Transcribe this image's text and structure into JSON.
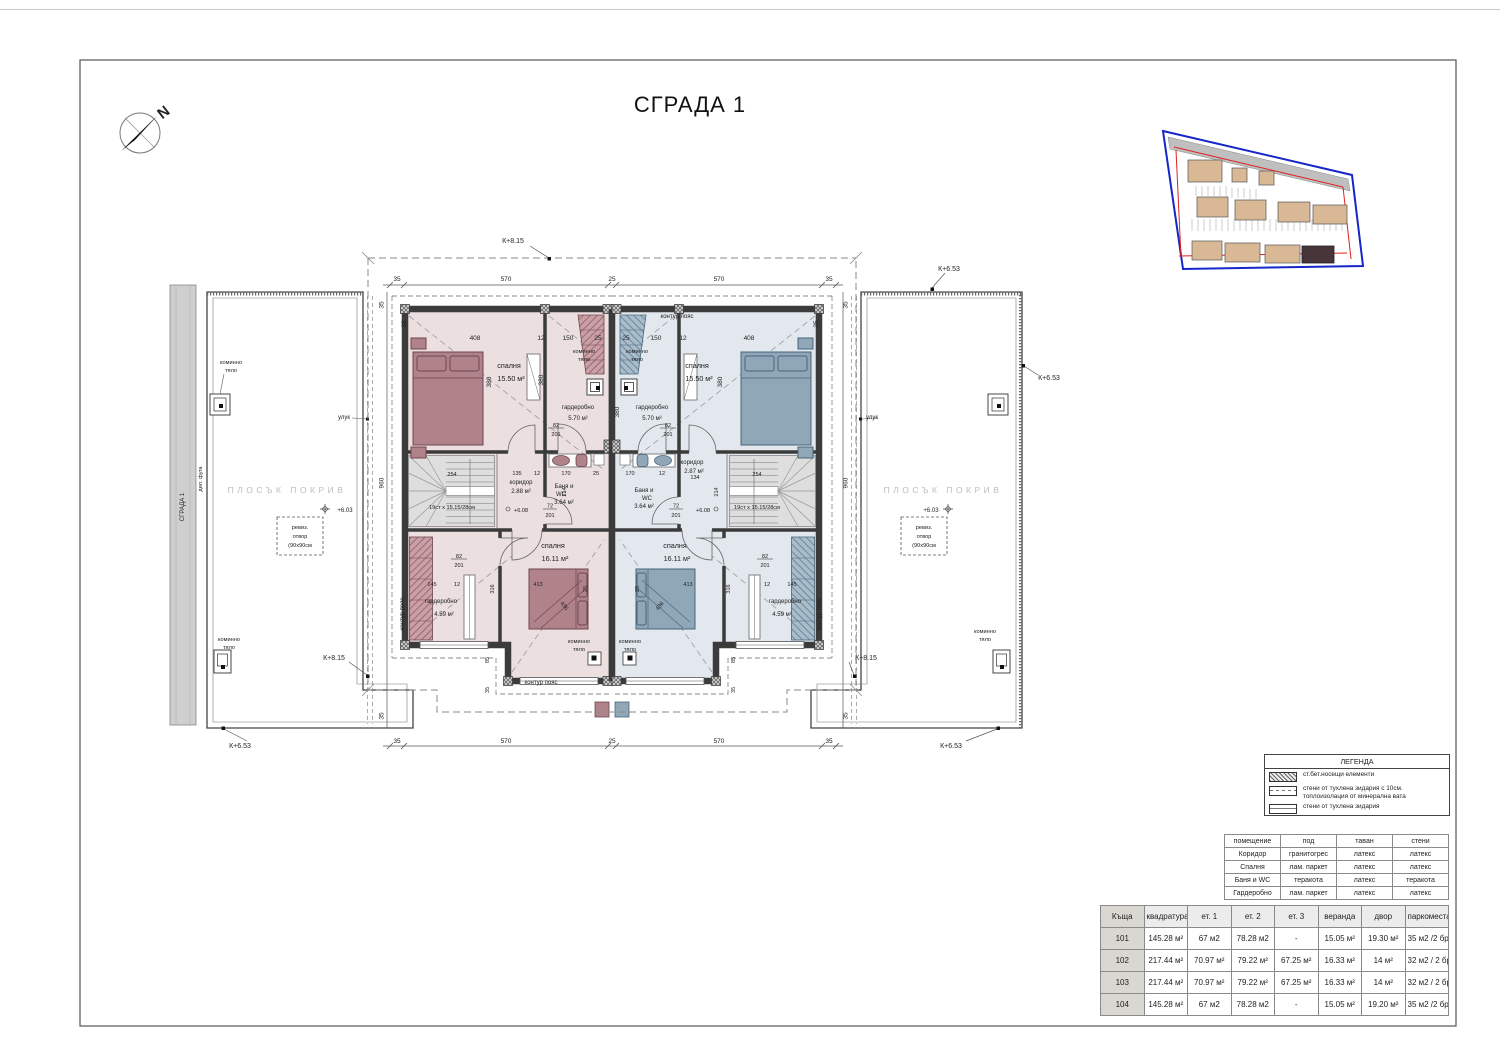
{
  "title": "СГРАДА 1",
  "compass": {
    "north": "N"
  },
  "plan": {
    "labels": {
      "flat_roof": "ПЛОСЪК ПОКРИВ",
      "building_strip": "СГРАДА 1",
      "dilation_joint": "дил. фуга",
      "chimney_l1": "коминно",
      "chimney_l2": "тяло",
      "gutter": "улук",
      "contour_belt": "контур пояс",
      "revision_l1": "ревиз.",
      "revision_l2": "отвор",
      "revision_l3": "(90х90см",
      "stairs_spec": "19ст х 15.15/28см"
    },
    "levels": {
      "l603": "+6.03",
      "l608": "+6.08",
      "k815": "К+8.15",
      "k653": "К+6.53"
    },
    "rooms": {
      "bedroom_top": {
        "name": "спалня",
        "area": "15.50 м²"
      },
      "bedroom_bottom": {
        "name": "спалня",
        "area": "16.11 м²"
      },
      "wardrobe_top": {
        "name": "гардеробно",
        "area": "5.70 м²"
      },
      "wardrobe_bottom": {
        "name": "гардеробно",
        "area": "4.59 м²"
      },
      "corridor_left": {
        "name": "коридор",
        "area": "2.88 м²"
      },
      "corridor_right": {
        "name": "коридор",
        "area": "2.87 м²"
      },
      "bath": {
        "name_l1": "Баня и",
        "name_l2": "WC",
        "area": "3.64 м²"
      }
    },
    "dims": {
      "d35": "35",
      "d25": "25",
      "d570": "570",
      "d12": "12",
      "d408": "408",
      "d150": "150",
      "d380": "380",
      "d960": "960",
      "d82": "82",
      "d201": "201",
      "d214": "214",
      "d72": "72",
      "d170": "170",
      "d135": "135",
      "d134": "134",
      "d254": "254",
      "d316": "316",
      "d413": "413",
      "d145": "145",
      "d85": "85",
      "d436": "436"
    }
  },
  "legend": {
    "title": "ЛЕГЕНДА",
    "items": [
      "ст.бет.носещи елементи",
      "стени от тухлена зидария с 10см. топлоизолация от минерална вата",
      "стени от тухлена зидария"
    ]
  },
  "finishes_table": {
    "headers": [
      "помещение",
      "под",
      "таван",
      "стени"
    ],
    "rows": [
      [
        "Коридор",
        "гранитогрес",
        "латекс",
        "латекс"
      ],
      [
        "Спалня",
        "лам. паркет",
        "латекс",
        "латекс"
      ],
      [
        "Баня и WC",
        "теракота",
        "латекс",
        "теракота"
      ],
      [
        "Гардеробно",
        "лам. паркет",
        "латекс",
        "латекс"
      ]
    ]
  },
  "houses_table": {
    "headers": [
      "Къща",
      "квадратура",
      "ет. 1",
      "ет. 2",
      "ет. 3",
      "веранда",
      "двор",
      "паркоместа"
    ],
    "rows": [
      [
        "101",
        "145.28 м²",
        "67 м2",
        "78.28 м2",
        "-",
        "15.05 м²",
        "19.30 м²",
        "35 м2 /2 бр."
      ],
      [
        "102",
        "217.44 м²",
        "70.97 м²",
        "79.22 м²",
        "67.25 м²",
        "16.33 м²",
        "14 м²",
        "32 м2 / 2 бр."
      ],
      [
        "103",
        "217.44 м²",
        "70.97 м²",
        "79.22 м²",
        "67.25 м²",
        "16.33 м²",
        "14 м²",
        "32 м2 / 2 бр."
      ],
      [
        "104",
        "145.28 м²",
        "67 м2",
        "78.28 м2",
        "-",
        "15.05 м²",
        "19.20 м²",
        "35 м2 /2 бр."
      ]
    ]
  },
  "colors": {
    "unit_left_floor": "#ebdfe0",
    "unit_right_floor": "#e2e8ee",
    "furniture_left": "#b08289",
    "furniture_right": "#90a7b8",
    "site_boundary": "#1626c8",
    "site_red_line": "#e02020",
    "highlight_building": "#47353a"
  }
}
